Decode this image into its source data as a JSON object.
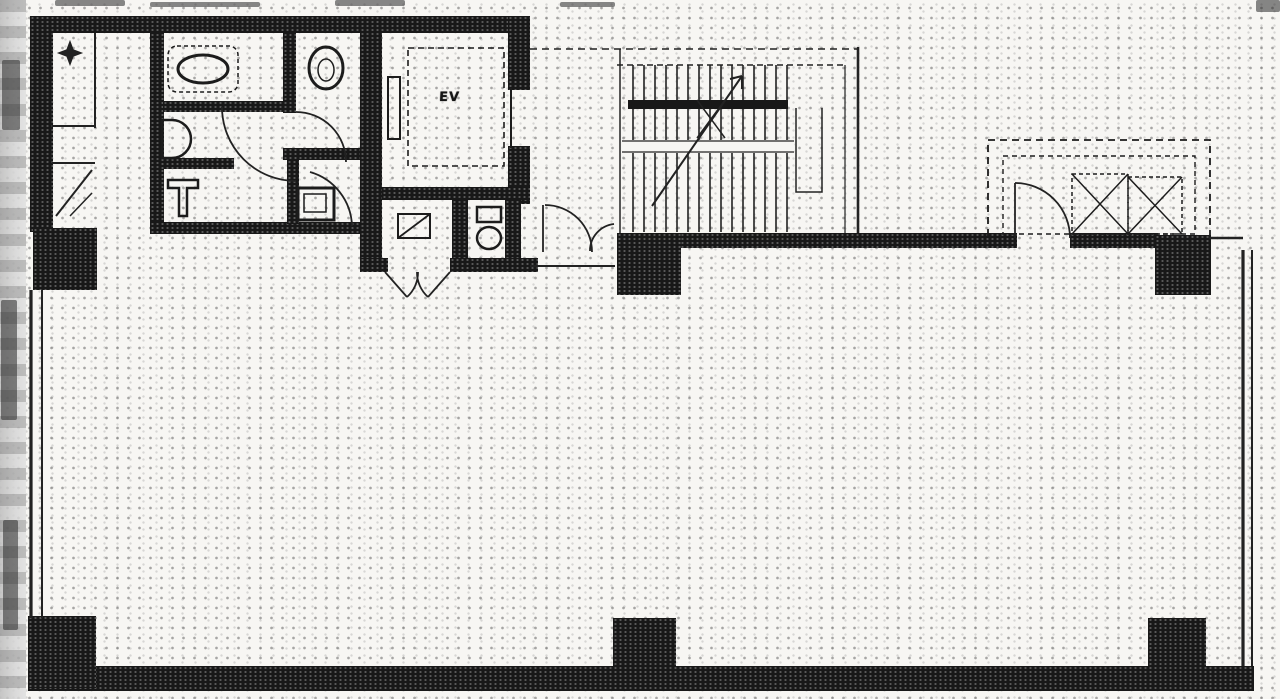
{
  "document": {
    "kind": "scanned architectural floor plan",
    "media": "black-and-white halftone scan",
    "visible_text": [
      "EV"
    ]
  },
  "labels": {
    "elevator": "EV"
  },
  "colors": {
    "paper": "#f7f6f3",
    "ink": "#181818",
    "halftone_dot": "#232323",
    "scan_edge_gray": "#bdbdbd"
  },
  "features": {
    "service_core": "restrooms, elevator shaft and service rooms along the top-left",
    "staircase": "dog-leg stair, top centre",
    "machine_room": "dashed unit with two crossed shafts, top right",
    "open_floor": "large open office area with perimeter window walls",
    "columns": "six structural columns (black squares)"
  }
}
